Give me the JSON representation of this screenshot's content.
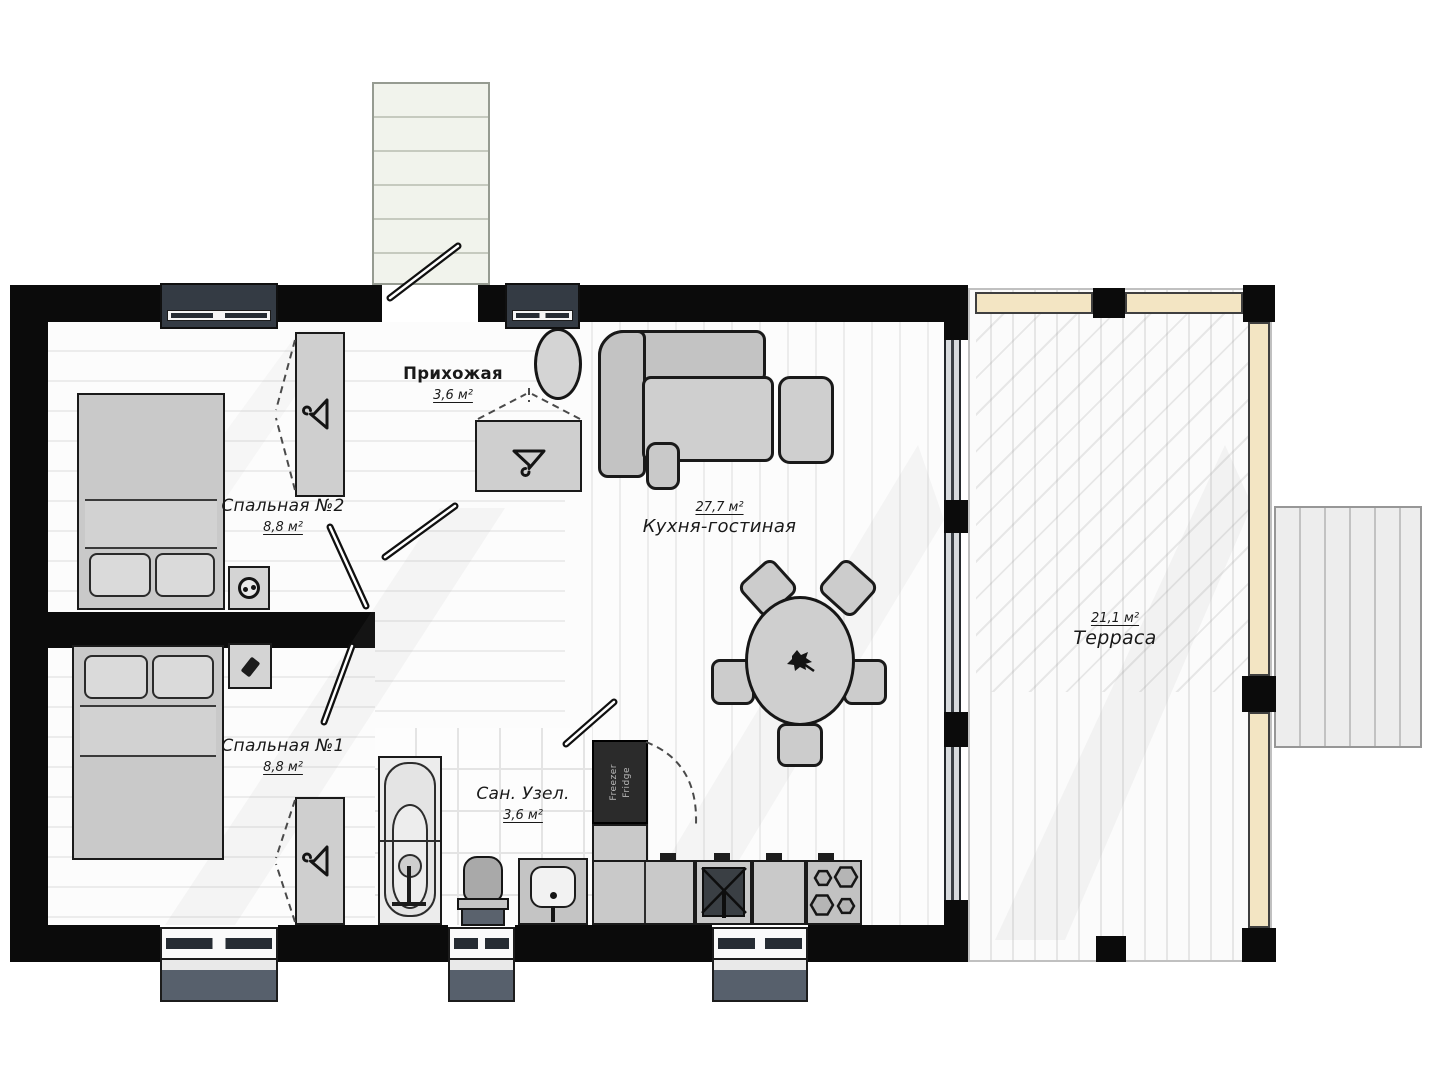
{
  "rooms": {
    "hallway": {
      "name": "Прихожая",
      "area": "3,6 м²"
    },
    "bedroom2": {
      "name": "Спальная №2",
      "area": "8,8 м²"
    },
    "bedroom1": {
      "name": "Спальная №1",
      "area": "8,8 м²"
    },
    "kitchen_living": {
      "name": "Кухня-гостиная",
      "area": "27,7 м²"
    },
    "bathroom": {
      "name": "Сан. Узел.",
      "area": "3,6 м²"
    },
    "terrace": {
      "name": "Терраса",
      "area": "21,1 м²"
    }
  },
  "appliances": {
    "fridge_line1": "Freezer",
    "fridge_line2": "Fridge"
  },
  "colors": {
    "wall": "#0b0b0b",
    "railing_beige": "#f3e5c3",
    "window_frame": "#343b44",
    "furniture_gray": "#cccccc"
  }
}
